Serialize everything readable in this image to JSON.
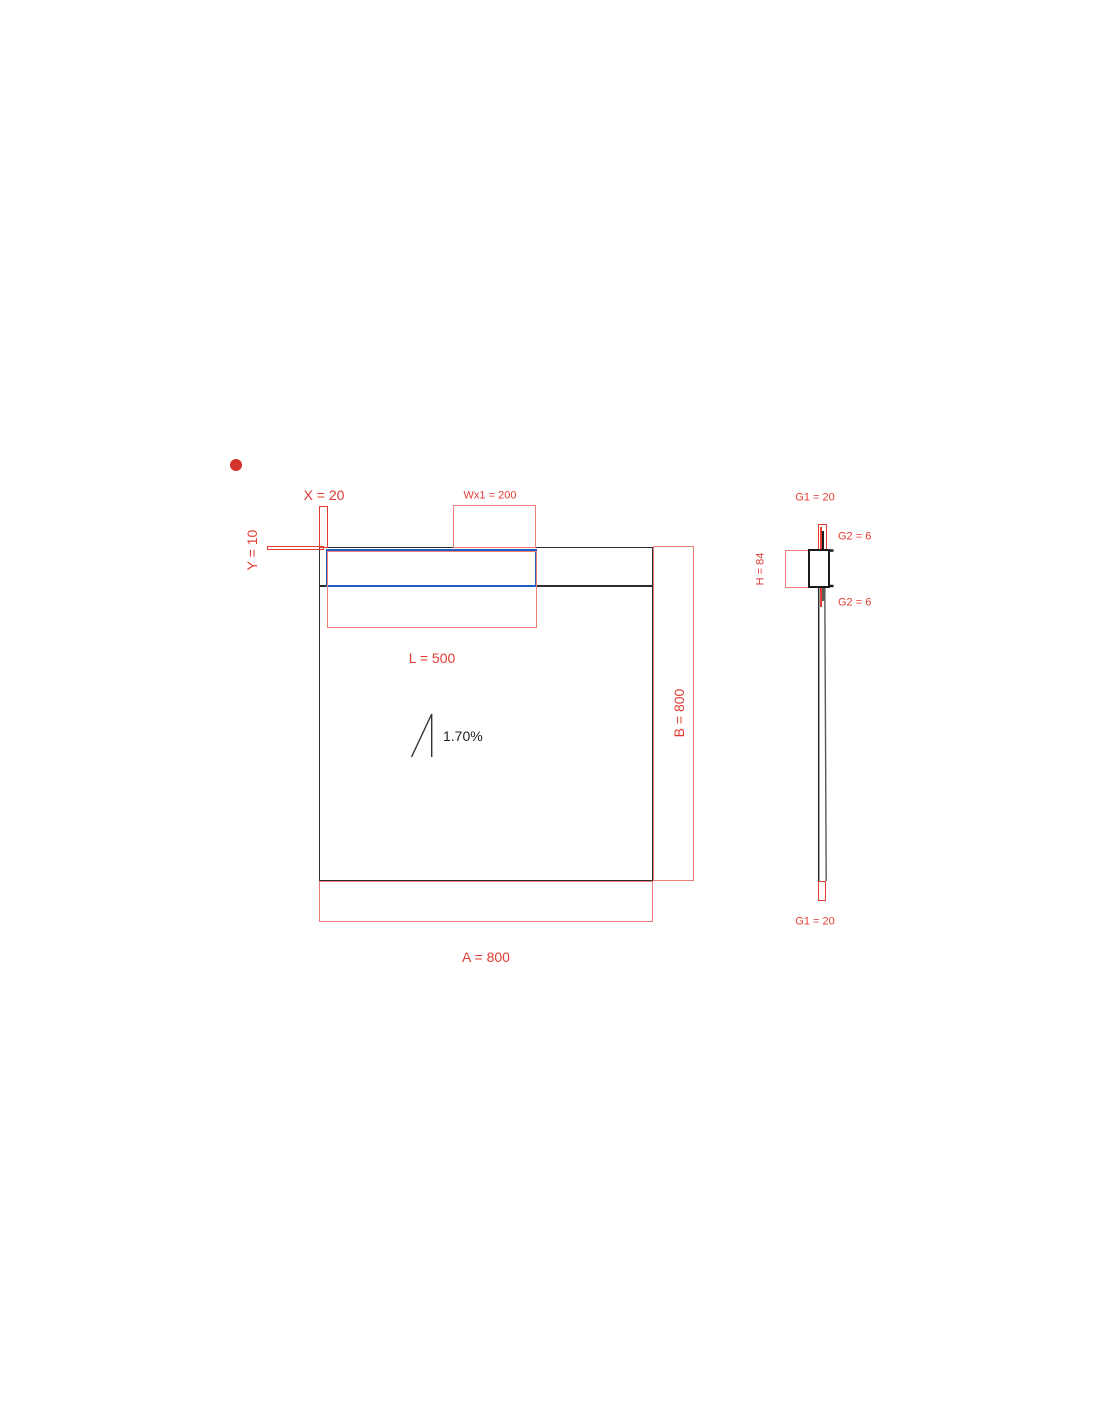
{
  "colors": {
    "red": "#e23b32",
    "red_light": "#ef7d76",
    "blue": "#1e5fc1",
    "line": "#2e2e2e",
    "dot": "#d4332c"
  },
  "plan": {
    "x_dim": "X = 20",
    "y_dim": "Y = 10",
    "wx1_dim": "Wx1 = 200",
    "l_dim": "L = 500",
    "b_dim": "B = 800",
    "a_dim": "A = 800",
    "slope": "1.70%"
  },
  "section": {
    "g1_top": "G1 = 20",
    "g2_top": "G2 = 6",
    "h_dim": "H = 84",
    "g2_bottom": "G2 = 6",
    "g1_bottom": "G1 = 20"
  }
}
